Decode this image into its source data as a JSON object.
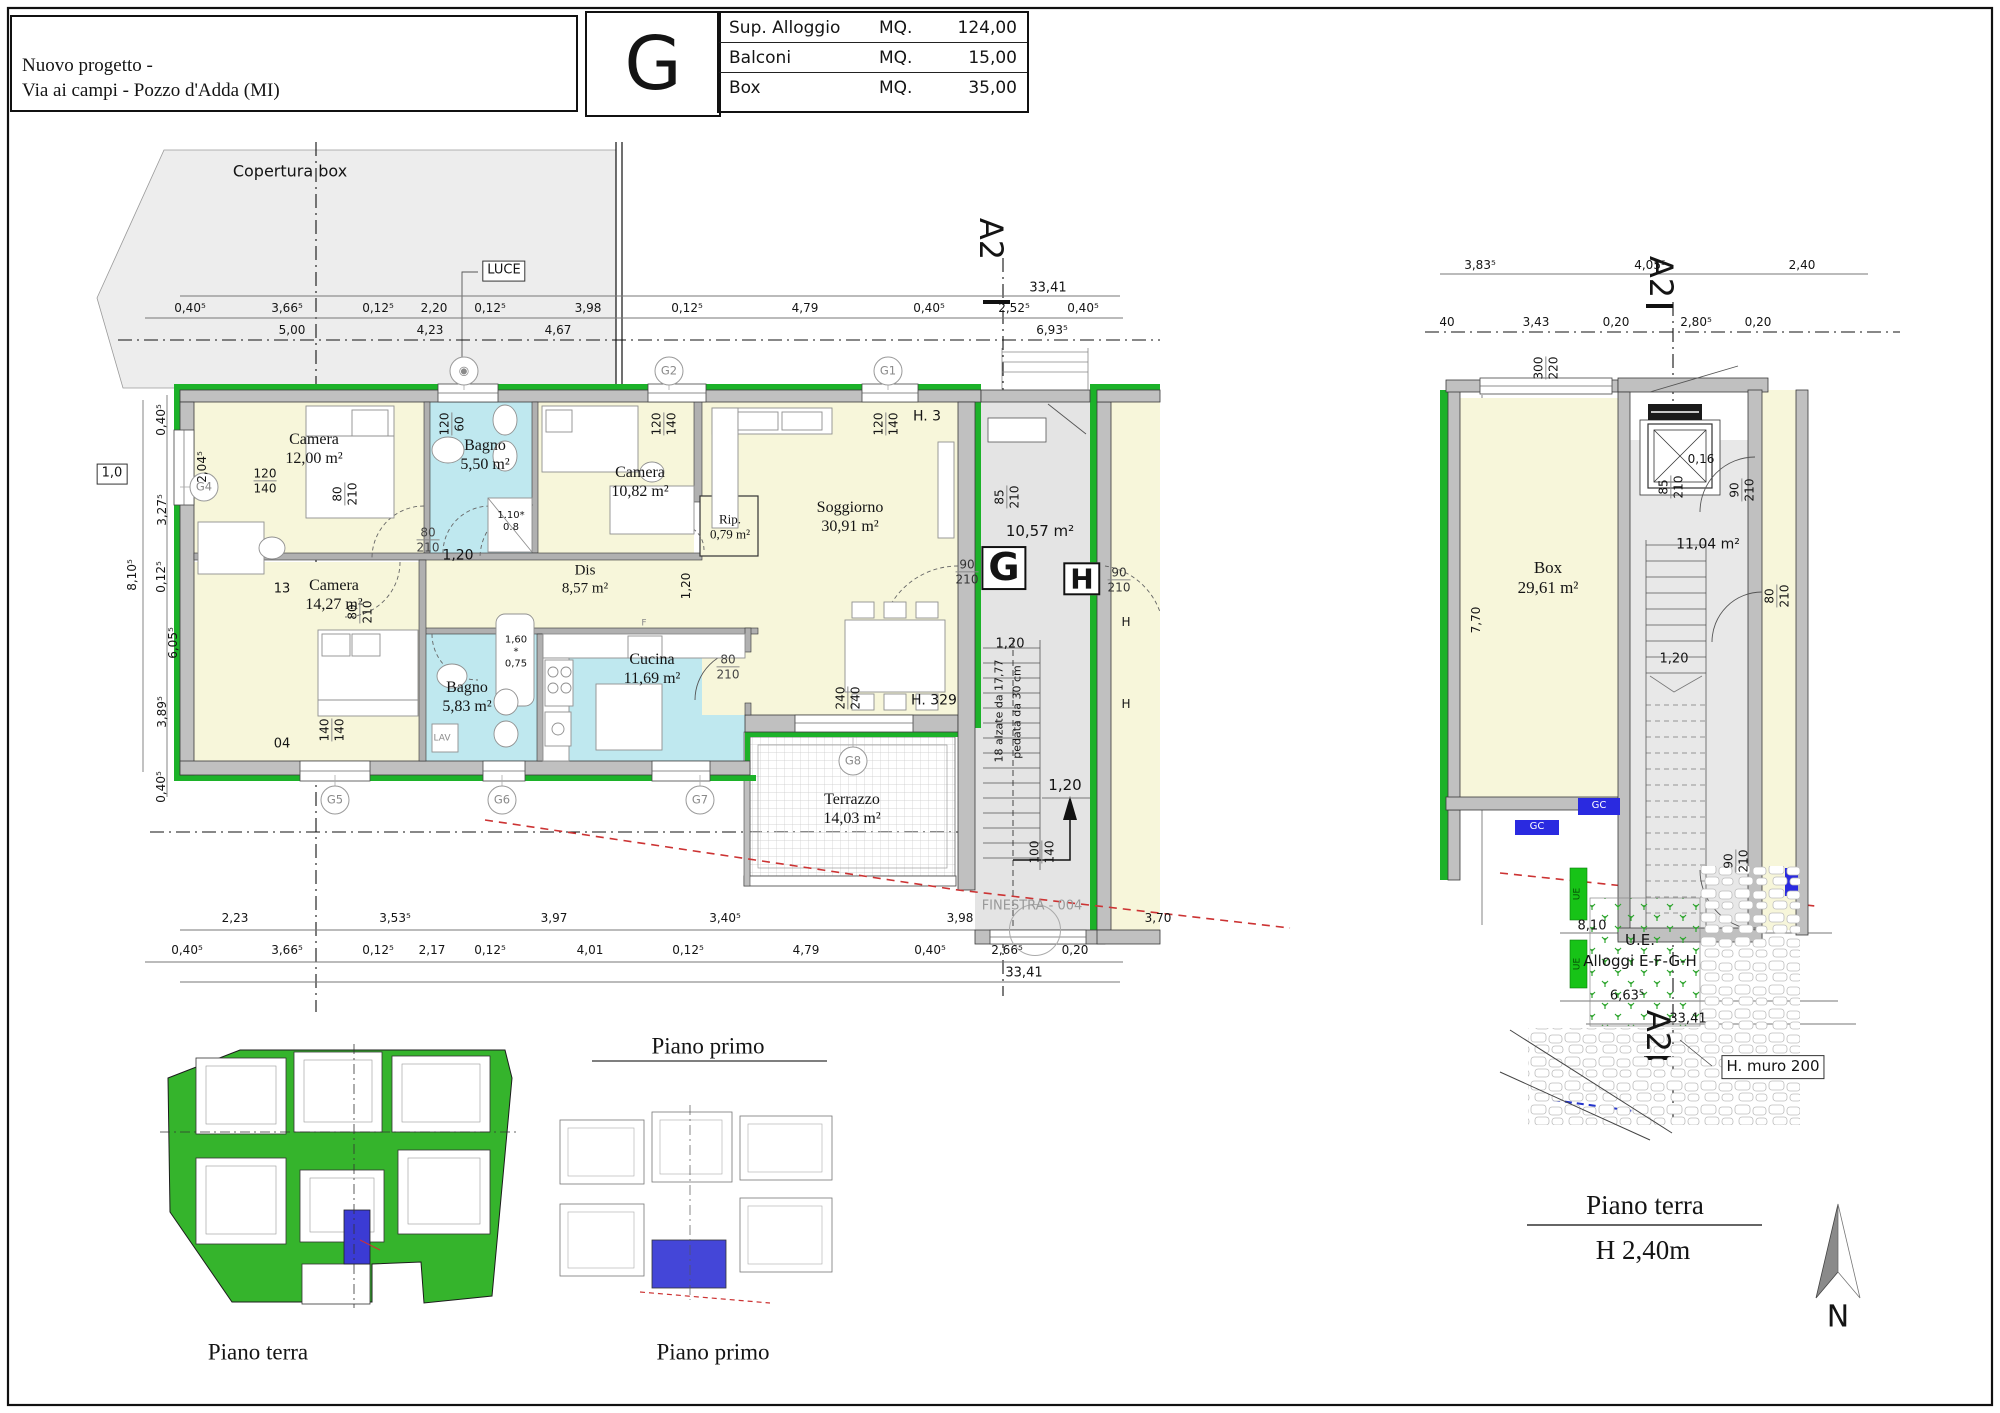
{
  "header": {
    "title_line1": "Nuovo progetto -",
    "title_line2": "Via ai campi - Pozzo d'Adda (MI)",
    "unit_letter": "G",
    "table": [
      {
        "label": "Sup. Alloggio",
        "mq": "MQ.",
        "value": "124,00"
      },
      {
        "label": "Balconi",
        "mq": "MQ.",
        "value": "15,00"
      },
      {
        "label": "Box",
        "mq": "MQ.",
        "value": "35,00"
      }
    ]
  },
  "colors": {
    "wall_green": "#1cb229",
    "room_cream": "#f7f6da",
    "room_cyan": "#bfe8ef",
    "common_gray": "#e4e4e4",
    "copertura_gray": "#ededed",
    "highlight_blue": "#3b3bd4",
    "marker_red": "#cc3333",
    "site_green": "#35b42c"
  },
  "rooms_main": [
    {
      "t": "Camera\n12,00 m²",
      "x": 314,
      "y": 450,
      "f": "serif",
      "s": 16,
      "n": "room-label-camera1"
    },
    {
      "t": "Bagno\n5,50 m²",
      "x": 485,
      "y": 456,
      "f": "serif",
      "s": 16,
      "n": "room-label-bagno1"
    },
    {
      "t": "Camera\n10,82 m²",
      "x": 640,
      "y": 483,
      "f": "serif",
      "s": 16,
      "n": "room-label-camera2"
    },
    {
      "t": "Rip.\n0,79 m²",
      "x": 730,
      "y": 527,
      "f": "serif",
      "s": 13,
      "n": "room-label-rip"
    },
    {
      "t": "Soggiorno\n30,91 m²",
      "x": 850,
      "y": 518,
      "f": "serif",
      "s": 16,
      "n": "room-label-soggiorno"
    },
    {
      "t": "Dis\n8,57 m²",
      "x": 585,
      "y": 580,
      "f": "serif",
      "s": 15,
      "n": "room-label-dis"
    },
    {
      "t": "Camera\n14,27 m²",
      "x": 334,
      "y": 596,
      "f": "serif",
      "s": 16,
      "n": "room-label-camera3"
    },
    {
      "t": "Bagno\n5,83 m²",
      "x": 467,
      "y": 698,
      "f": "serif",
      "s": 16,
      "n": "room-label-bagno2"
    },
    {
      "t": "Cucina\n11,69 m²",
      "x": 652,
      "y": 670,
      "f": "serif",
      "s": 16,
      "n": "room-label-cucina"
    },
    {
      "t": "Terrazzo\n14,03 m²",
      "x": 852,
      "y": 810,
      "f": "serif",
      "s": 16,
      "n": "room-label-terrazzo"
    }
  ],
  "rooms_right": [
    {
      "t": "Box\n29,61 m²",
      "x": 1548,
      "y": 578,
      "f": "serif",
      "s": 17,
      "n": "room-label-box"
    },
    {
      "t": "10,57 m²",
      "x": 1040,
      "y": 532,
      "s": 15,
      "n": "room-label-landing"
    },
    {
      "t": "11,04 m²",
      "x": 1708,
      "y": 545,
      "s": 14,
      "n": "room-label-landing-gf"
    }
  ],
  "bubbles": [
    {
      "t": "G2",
      "x": 669,
      "y": 371,
      "cls": "bubble",
      "n": "grid-bubble-g2"
    },
    {
      "t": "G1",
      "x": 888,
      "y": 371,
      "cls": "bubble",
      "n": "grid-bubble-g1"
    },
    {
      "t": "◉",
      "x": 464,
      "y": 371,
      "cls": "bubble",
      "s": 12,
      "n": "vent-bubble"
    },
    {
      "t": "G4",
      "x": 204,
      "y": 487,
      "cls": "bubble",
      "n": "grid-bubble-g4"
    },
    {
      "t": "G5",
      "x": 335,
      "y": 800,
      "cls": "bubble",
      "n": "grid-bubble-g5"
    },
    {
      "t": "G6",
      "x": 502,
      "y": 800,
      "cls": "bubble",
      "n": "grid-bubble-g6"
    },
    {
      "t": "G7",
      "x": 700,
      "y": 800,
      "cls": "bubble",
      "n": "grid-bubble-g7"
    },
    {
      "t": "G8",
      "x": 853,
      "y": 761,
      "cls": "bubble",
      "n": "grid-bubble-g8"
    },
    {
      "t": "",
      "x": 1035,
      "y": 930,
      "cls": "bubble-lg",
      "n": "finestra-bubble"
    }
  ],
  "annotations_main": [
    {
      "t": "Copertura box",
      "x": 290,
      "y": 172,
      "s": 16,
      "n": "copertura-label"
    },
    {
      "t": "LUCE",
      "x": 504,
      "y": 271,
      "s": 13,
      "cls": "chip",
      "n": "luce-label"
    },
    {
      "t": "H. 3",
      "x": 927,
      "y": 417,
      "s": 14,
      "n": "sill-height-label"
    },
    {
      "t": "H. 329",
      "x": 934,
      "y": 701,
      "s": 14,
      "n": "sill-height-label"
    },
    {
      "t": "13",
      "x": 282,
      "y": 589,
      "s": 13,
      "n": "ref-number"
    },
    {
      "t": "04",
      "x": 282,
      "y": 744,
      "s": 13,
      "n": "ref-number"
    },
    {
      "t": "LAV",
      "x": 442,
      "y": 739,
      "s": 9,
      "c": "#8a8a8a",
      "n": "lav-label"
    },
    {
      "t": "F",
      "x": 644,
      "y": 624,
      "s": 9,
      "c": "#8a8a8a",
      "n": "fridge-label"
    },
    {
      "t": "1,0",
      "x": 112,
      "y": 474,
      "s": 13,
      "cls": "chip",
      "n": "edge-chip"
    },
    {
      "t": "G",
      "x": 1004,
      "y": 568,
      "s": 38,
      "cls": "letterbox",
      "n": "unit-g-marker"
    },
    {
      "t": "H",
      "x": 1082,
      "y": 579,
      "s": 28,
      "cls": "letterbox",
      "n": "unit-h-marker"
    },
    {
      "t": "1.10*\n0.8",
      "x": 511,
      "y": 522,
      "s": 10,
      "n": "shower-size"
    },
    {
      "t": "1,60\n*\n0,75",
      "x": 516,
      "y": 652,
      "s": 10,
      "n": "tub-size"
    },
    {
      "t": "18 alzate da 17,77",
      "x": 1000,
      "y": 711,
      "r": -90,
      "s": 11,
      "n": "stair-note"
    },
    {
      "t": "pedata da 30 cm",
      "x": 1018,
      "y": 712,
      "r": -90,
      "s": 11,
      "n": "stair-note"
    },
    {
      "t": "FINESTRA - 004",
      "x": 1032,
      "y": 906,
      "s": 13,
      "c": "#999999",
      "n": "finestra-label"
    },
    {
      "t": "A2",
      "x": 990,
      "y": 239,
      "r": 90,
      "s": 32,
      "n": "section-marker-a2"
    },
    {
      "t": "H",
      "x": 1126,
      "y": 622,
      "s": 12,
      "n": "partial-label"
    },
    {
      "t": "H",
      "x": 1126,
      "y": 704,
      "s": 12,
      "n": "partial-label"
    },
    {
      "t": "1,20",
      "x": 458,
      "y": 556,
      "s": 14,
      "n": "dim"
    },
    {
      "t": "1,20",
      "x": 686,
      "y": 586,
      "r": -90,
      "s": 12,
      "n": "dim"
    },
    {
      "t": "1,20",
      "x": 1010,
      "y": 644,
      "s": 13,
      "n": "dim"
    },
    {
      "t": "1,20",
      "x": 1065,
      "y": 786,
      "s": 15,
      "n": "dim"
    }
  ],
  "fractions": [
    {
      "t": "120\n140",
      "x": 265,
      "y": 481
    },
    {
      "t": "120\n60",
      "x": 452,
      "y": 424,
      "r": -90
    },
    {
      "t": "120\n140",
      "x": 664,
      "y": 424,
      "r": -90
    },
    {
      "t": "120\n140",
      "x": 886,
      "y": 424,
      "r": -90
    },
    {
      "t": "80\n210",
      "x": 428,
      "y": 540,
      "c": "#444444",
      "s": 12
    },
    {
      "t": "80\n210",
      "x": 345,
      "y": 494,
      "r": -90
    },
    {
      "t": "80\n210",
      "x": 360,
      "y": 612,
      "r": -90
    },
    {
      "t": "80\n210",
      "x": 728,
      "y": 667,
      "c": "#444444",
      "s": 12
    },
    {
      "t": "90\n210",
      "x": 967,
      "y": 572,
      "c": "#333333",
      "s": 12
    },
    {
      "t": "90\n210",
      "x": 1119,
      "y": 580,
      "c": "#333333",
      "s": 12
    },
    {
      "t": "85\n210",
      "x": 1007,
      "y": 497,
      "r": -90
    },
    {
      "t": "100\n140",
      "x": 1042,
      "y": 852,
      "r": -90
    },
    {
      "t": "240\n240",
      "x": 848,
      "y": 698,
      "r": -90
    },
    {
      "t": "140\n140",
      "x": 332,
      "y": 730,
      "r": -90
    },
    {
      "t": "300\n220",
      "x": 1546,
      "y": 368,
      "r": -90
    },
    {
      "t": "85\n210",
      "x": 1671,
      "y": 487,
      "r": -90
    },
    {
      "t": "90\n210",
      "x": 1742,
      "y": 490,
      "r": -90
    },
    {
      "t": "80\n210",
      "x": 1777,
      "y": 596,
      "r": -90
    },
    {
      "t": "90\n210",
      "x": 1736,
      "y": 861,
      "r": -90
    }
  ],
  "dims_main": [
    {
      "t": "0,40⁵",
      "x": 190,
      "y": 308
    },
    {
      "t": "3,66⁵",
      "x": 287,
      "y": 308
    },
    {
      "t": "0,12⁵",
      "x": 378,
      "y": 308
    },
    {
      "t": "2,20",
      "x": 434,
      "y": 308
    },
    {
      "t": "0,12⁵",
      "x": 490,
      "y": 308
    },
    {
      "t": "3,98",
      "x": 588,
      "y": 308
    },
    {
      "t": "0,12⁵",
      "x": 687,
      "y": 308
    },
    {
      "t": "4,79",
      "x": 805,
      "y": 308
    },
    {
      "t": "0,40⁵",
      "x": 929,
      "y": 308
    },
    {
      "t": "2,52⁵",
      "x": 1014,
      "y": 308
    },
    {
      "t": "0,40⁵",
      "x": 1083,
      "y": 308
    },
    {
      "t": "5,00",
      "x": 292,
      "y": 330
    },
    {
      "t": "4,23",
      "x": 430,
      "y": 330
    },
    {
      "t": "4,67",
      "x": 558,
      "y": 330
    },
    {
      "t": "6,93⁵",
      "x": 1052,
      "y": 330
    },
    {
      "t": "33,41",
      "x": 1048,
      "y": 288,
      "s": 13
    },
    {
      "t": "2,23",
      "x": 235,
      "y": 918
    },
    {
      "t": "3,53⁵",
      "x": 395,
      "y": 918
    },
    {
      "t": "3,97",
      "x": 554,
      "y": 918
    },
    {
      "t": "3,40⁵",
      "x": 725,
      "y": 918
    },
    {
      "t": "3,98",
      "x": 960,
      "y": 918
    },
    {
      "t": "3,70",
      "x": 1158,
      "y": 918
    },
    {
      "t": "0,40⁵",
      "x": 187,
      "y": 950
    },
    {
      "t": "3,66⁵",
      "x": 287,
      "y": 950
    },
    {
      "t": "0,12⁵",
      "x": 378,
      "y": 950
    },
    {
      "t": "2,17",
      "x": 432,
      "y": 950
    },
    {
      "t": "0,12⁵",
      "x": 490,
      "y": 950
    },
    {
      "t": "4,01",
      "x": 590,
      "y": 950
    },
    {
      "t": "0,12⁵",
      "x": 688,
      "y": 950
    },
    {
      "t": "4,79",
      "x": 806,
      "y": 950
    },
    {
      "t": "0,40⁵",
      "x": 930,
      "y": 950
    },
    {
      "t": "2,66⁵",
      "x": 1007,
      "y": 950
    },
    {
      "t": "0,20",
      "x": 1075,
      "y": 950
    },
    {
      "t": "33,41",
      "x": 1024,
      "y": 973,
      "s": 13
    },
    {
      "t": "0,40⁵",
      "x": 161,
      "y": 420,
      "r": -90
    },
    {
      "t": "2,04⁵",
      "x": 202,
      "y": 467,
      "r": -90
    },
    {
      "t": "3,27⁵",
      "x": 162,
      "y": 510,
      "r": -90
    },
    {
      "t": "0,12⁵",
      "x": 161,
      "y": 577,
      "r": -90
    },
    {
      "t": "6,05⁵",
      "x": 173,
      "y": 643,
      "r": -90
    },
    {
      "t": "3,89⁵",
      "x": 162,
      "y": 712,
      "r": -90
    },
    {
      "t": "0,40⁵",
      "x": 161,
      "y": 787,
      "r": -90
    },
    {
      "t": "8,10⁵",
      "x": 132,
      "y": 575,
      "r": -90
    }
  ],
  "dims_right": [
    {
      "t": "3,83⁵",
      "x": 1480,
      "y": 265
    },
    {
      "t": "4,05⁵",
      "x": 1650,
      "y": 265
    },
    {
      "t": "2,40",
      "x": 1802,
      "y": 265
    },
    {
      "t": "40",
      "x": 1447,
      "y": 322
    },
    {
      "t": "3,43",
      "x": 1536,
      "y": 322
    },
    {
      "t": "0,20",
      "x": 1616,
      "y": 322
    },
    {
      "t": "2,80⁵",
      "x": 1696,
      "y": 322
    },
    {
      "t": "0,20",
      "x": 1758,
      "y": 322
    },
    {
      "t": "7,70",
      "x": 1476,
      "y": 620,
      "r": -90
    },
    {
      "t": "1,20",
      "x": 1674,
      "y": 659,
      "s": 13
    },
    {
      "t": "0,16",
      "x": 1701,
      "y": 459
    },
    {
      "t": "8,10",
      "x": 1592,
      "y": 926,
      "s": 13
    },
    {
      "t": "6,63⁵",
      "x": 1627,
      "y": 996,
      "s": 13
    },
    {
      "t": "33,41",
      "x": 1688,
      "y": 1019,
      "s": 13
    },
    {
      "t": "A2",
      "x": 1660,
      "y": 277,
      "r": 90,
      "s": 32,
      "n": "section-marker-a2"
    },
    {
      "t": "A2",
      "x": 1657,
      "y": 1031,
      "r": 90,
      "s": 32,
      "n": "section-marker-a2"
    },
    {
      "t": "U.E.",
      "x": 1640,
      "y": 941,
      "s": 15,
      "n": "ue-label"
    },
    {
      "t": "Alloggi E-F-G-H",
      "x": 1640,
      "y": 962,
      "s": 15,
      "n": "ue-label"
    },
    {
      "t": "H. muro 200",
      "x": 1773,
      "y": 1067,
      "s": 15,
      "cls": "chip",
      "n": "wall-height-chip"
    },
    {
      "t": "GC",
      "x": 1599,
      "y": 806,
      "s": 10,
      "c": "#ffffff",
      "n": "gc-marker"
    },
    {
      "t": "GC",
      "x": 1537,
      "y": 827,
      "s": 10,
      "c": "#ffffff",
      "n": "gc-marker"
    },
    {
      "t": "UE",
      "x": 1578,
      "y": 894,
      "r": -90,
      "s": 9,
      "c": "#064f06",
      "n": "ue-marker"
    },
    {
      "t": "UE",
      "x": 1578,
      "y": 964,
      "r": -90,
      "s": 9,
      "c": "#064f06",
      "n": "ue-marker"
    }
  ],
  "footer": [
    {
      "t": "Piano primo",
      "x": 708,
      "y": 1046,
      "f": "serif",
      "s": 23,
      "n": "caption-piano-primo-top"
    },
    {
      "t": "Piano terra",
      "x": 258,
      "y": 1352,
      "f": "serif",
      "s": 23,
      "n": "caption-piano-terra-left"
    },
    {
      "t": "Piano primo",
      "x": 713,
      "y": 1352,
      "f": "serif",
      "s": 23,
      "n": "caption-piano-primo-bottom"
    },
    {
      "t": "Piano terra",
      "x": 1645,
      "y": 1206,
      "f": "serif",
      "s": 27,
      "n": "caption-piano-terra-right"
    },
    {
      "t": "H 2,40m",
      "x": 1643,
      "y": 1251,
      "f": "serif",
      "s": 27,
      "n": "height-caption"
    },
    {
      "t": "N",
      "x": 1838,
      "y": 1317,
      "s": 30,
      "n": "north-label"
    }
  ]
}
